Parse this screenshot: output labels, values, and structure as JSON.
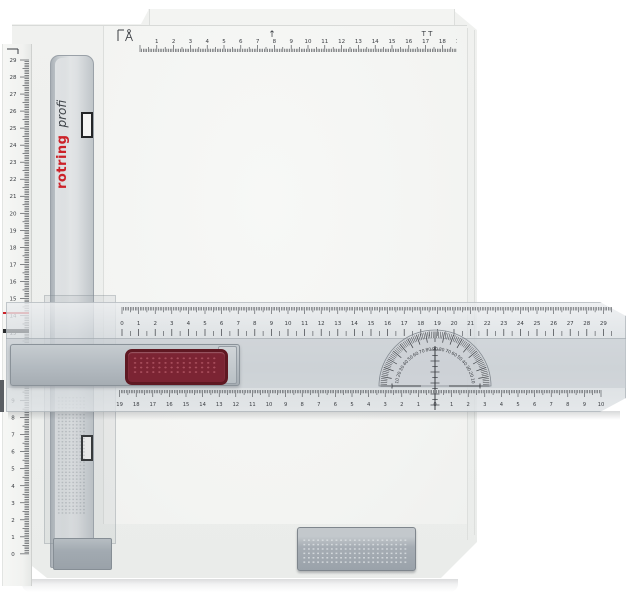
{
  "product": {
    "brand": "rotring",
    "model": "profi",
    "type_label": "drawing board"
  },
  "colors": {
    "brand_red": "#cc2229",
    "model_gray": "#3f4449",
    "grip_red": "#7b2433",
    "board_gray": "#eeefed",
    "rail_gray": "#c6cbcf",
    "tick_color": "#3a3d42"
  },
  "scales": {
    "board_top": {
      "min": 1,
      "max": 19,
      "bracket": "⌐",
      "arrow": "↑",
      "end_marks": "T T"
    },
    "board_left": {
      "min": 0,
      "max": 29,
      "bracket": "¬"
    },
    "edge_top": {
      "min": 0,
      "max": 29
    },
    "edge_bottom": {
      "center_value": 0,
      "left_count": 19,
      "right_count": 10
    },
    "protractor": {
      "label_step": 10,
      "peak": 90,
      "tick_step": 2
    }
  },
  "icons": {
    "compass": "compass-icon",
    "crosshair": "crosshair-icon"
  }
}
